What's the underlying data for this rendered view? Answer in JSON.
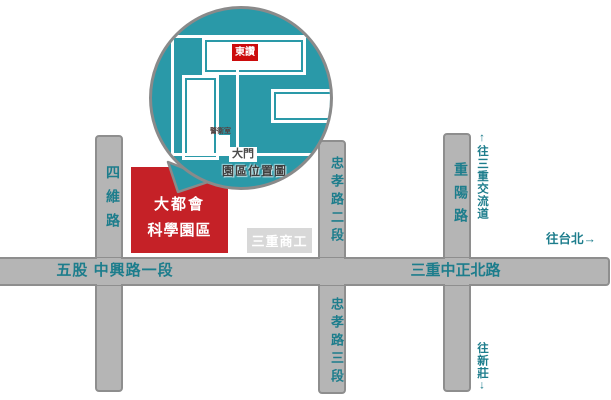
{
  "colors": {
    "inset_teal": "#2a99a8",
    "road_fill": "#b5b5b5",
    "road_border": "#8e8e8e",
    "road_text_teal": "#1d7d8c",
    "park_red": "#c52127",
    "badge_red": "#cc0c0c",
    "school_gray": "#d8d8d8"
  },
  "inset": {
    "company_label": "東讚",
    "guard_label": "警衛室",
    "gate_label": "大門",
    "caption": "園區位置圖"
  },
  "park_block": {
    "line1": "大都會",
    "line2": "科學園區"
  },
  "school_label": "三重商工",
  "roads": {
    "siwei": "四維路",
    "wugu_zhongxing": "五股 中興路一段",
    "zhongxiao_2": "忠孝路二段",
    "zhongxiao_3": "忠孝路三段",
    "sanchong_zhongzheng": "三重中正北路",
    "chongyang": "重陽路"
  },
  "directions": {
    "to_interchange": "↑往三重交流道",
    "to_taipei": "往台北→",
    "to_xinzhuang": "往新莊↓"
  }
}
